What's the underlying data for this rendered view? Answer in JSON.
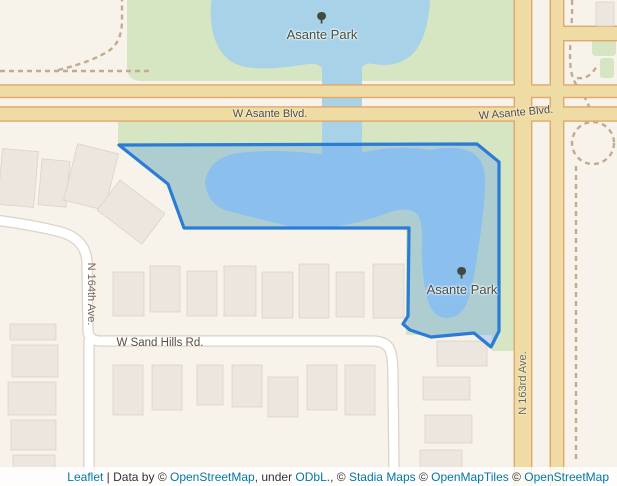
{
  "map_labels": {
    "asante_park_top": "Asante Park",
    "asante_park_south": "Asante Park",
    "w_asante_blvd_west": "W Asante Blvd.",
    "w_asante_blvd_east": "W Asante Blvd.",
    "w_sand_hills_rd": "W Sand Hills Rd.",
    "n_164th_ave": "N 164th Ave.",
    "n_163rd_ave": "N 163rd Ave."
  },
  "selection": {
    "points": "119,145 477,144 499,162 499,331 491,347 474,333 431,337 410,330 403,324 408,316 409,228 184,228 168,184",
    "stroke_color": "#2b7cd6",
    "fill_color": "rgba(51,136,255,0.25)"
  },
  "colors": {
    "background": "#f7f2ea",
    "water": "#a8d2e8",
    "park": "#d6e5c2",
    "road_fill": "#eedca4",
    "road_casing": "#e2a76a",
    "white_road": "#ffffff",
    "building": "#ece6df",
    "link": "#0078a8"
  },
  "attribution": {
    "leaflet": "Leaflet",
    "separator": " | ",
    "data_by": "Data by © ",
    "osm_link": "OpenStreetMap",
    "under": ", under ",
    "odbl_link": "ODbL.",
    "comma_c": ", © ",
    "stadia_link": "Stadia Maps",
    "c2": " © ",
    "openmaptiles_link": "OpenMapTiles",
    "c3": " © ",
    "osm2_link": "OpenStreetMap",
    "contributors": " contributors"
  }
}
